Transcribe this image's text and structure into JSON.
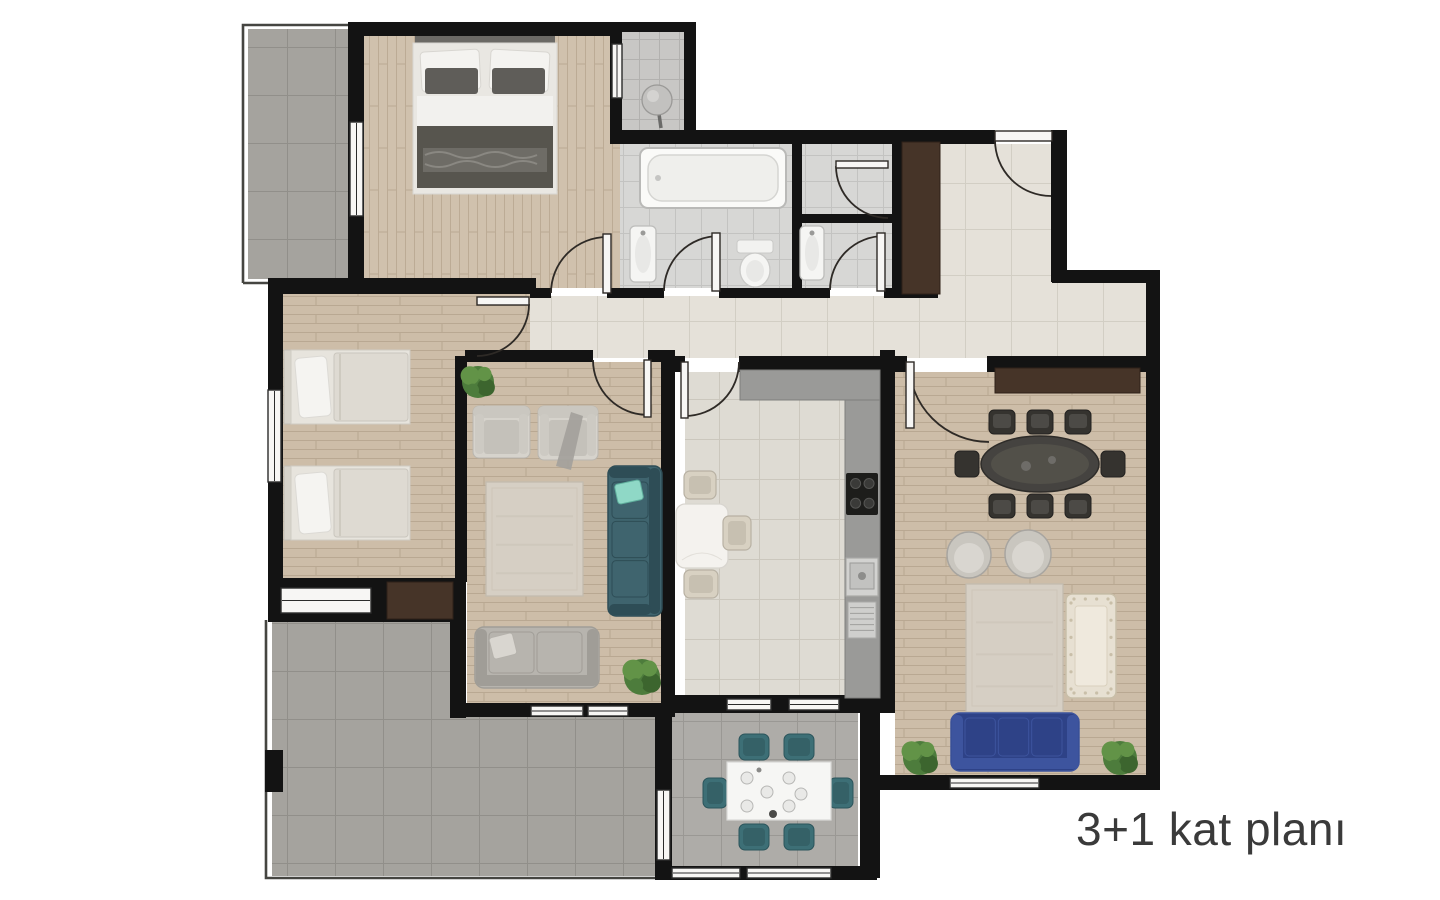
{
  "caption": {
    "text": "3+1 kat planı",
    "color": "#3a3a3a"
  },
  "palette": {
    "wall": "#131313",
    "door_line": "#2e2a26",
    "window_frame": "#2b2b2b",
    "railing": "#454541",
    "white": "#f7f6f4",
    "brown": "#463428",
    "counter": "#9a9a98",
    "counter_dark": "#7f7f7d",
    "sofa_navy": "#2e4287",
    "sofa_navy_cushion": "#3d549e",
    "teal": "#3f646e",
    "teal_dark": "#2e4d56",
    "mint": "#8fd8c6",
    "gray_sofa": "#b7b4ae",
    "gray_sofa_dark": "#a09d97",
    "cream": "#e7e0d2",
    "cream_dark": "#c9bfa9",
    "chair_dark": "#35332f",
    "chair_dark_seat": "#4c4a46",
    "table_dark": "#454340",
    "table_dark_hi": "#525049",
    "beige_chair": "#d8d1c2",
    "beige_chair_seat": "#c7c0b1",
    "balcony_chair": "#3d6f76",
    "balcony_chair_dark": "#2b545b",
    "rug": "#d6cfc4",
    "rug_line": "#c2bbae",
    "plant": "#4d7c3c",
    "plant2": "#629347",
    "plant3": "#3c652e",
    "linen": "#e9e7e2",
    "linen_dark": "#d8d6d1",
    "duvet_dark": "#57554e",
    "pillow_dark": "#5f5d59",
    "fixture": "#f5f5f3",
    "fixture_line": "#bdbdbb",
    "steel": "#c6c6c4"
  },
  "floor_patterns": {
    "wood_h": {
      "kind": "wood",
      "base": "#cdbda8",
      "line": "#b9a892",
      "vertical": false
    },
    "wood_v": {
      "kind": "wood",
      "base": "#d0c1ad",
      "line": "#bcab95",
      "vertical": true
    },
    "tile_hall": {
      "kind": "tile",
      "base": "#e5e1d9",
      "line": "#d2cec4",
      "size": 46
    },
    "tile_kitchen": {
      "kind": "tile",
      "base": "#dedbd3",
      "line": "#cbc7bd",
      "size": 40
    },
    "tile_bath": {
      "kind": "tile",
      "base": "#d7d7d5",
      "line": "#c3c3c1",
      "size": 26
    },
    "tile_niche": {
      "kind": "tile",
      "base": "#c8c7c5",
      "line": "#b2b1af",
      "size": 20
    },
    "tile_gray": {
      "kind": "tile",
      "base": "#a5a39e",
      "line": "#918f8a",
      "size": 48
    },
    "tile_balcony": {
      "kind": "tile",
      "base": "#aeaca8",
      "line": "#9a9894",
      "size": 38
    }
  },
  "floorplan": {
    "floors": [
      {
        "name": "room-balcony-top-left",
        "rect": [
          248,
          29,
          100,
          250
        ],
        "pattern": "tile_gray"
      },
      {
        "name": "room-master-bedroom",
        "rect": [
          364,
          36,
          258,
          252
        ],
        "pattern": "wood_v"
      },
      {
        "name": "room-niche",
        "rect": [
          622,
          30,
          64,
          104
        ],
        "pattern": "tile_niche"
      },
      {
        "name": "room-bathroom",
        "rect": [
          620,
          144,
          172,
          144
        ],
        "pattern": "tile_bath"
      },
      {
        "name": "room-shower",
        "rect": [
          802,
          144,
          90,
          72
        ],
        "pattern": "tile_bath"
      },
      {
        "name": "room-wc",
        "rect": [
          802,
          223,
          90,
          65
        ],
        "pattern": "tile_bath"
      },
      {
        "name": "room-entry-hall",
        "rect": [
          938,
          144,
          114,
          138
        ],
        "pattern": "tile_hall"
      },
      {
        "name": "room-hall-lower",
        "rect": [
          938,
          282,
          208,
          76
        ],
        "pattern": "tile_hall"
      },
      {
        "name": "room-corridor",
        "rect": [
          530,
          296,
          416,
          62
        ],
        "pattern": "tile_hall"
      },
      {
        "name": "room-vestibule",
        "rect": [
          283,
          294,
          247,
          62
        ],
        "pattern": "wood_h"
      },
      {
        "name": "room-kids-bedroom",
        "rect": [
          283,
          294,
          172,
          288
        ],
        "pattern": "wood_h"
      },
      {
        "name": "room-sitting-room",
        "rect": [
          467,
          362,
          194,
          343
        ],
        "pattern": "wood_h"
      },
      {
        "name": "room-kitchen",
        "rect": [
          685,
          372,
          195,
          325
        ],
        "pattern": "tile_kitchen"
      },
      {
        "name": "room-living-room",
        "rect": [
          895,
          372,
          251,
          403
        ],
        "pattern": "wood_h"
      },
      {
        "name": "room-terrace-upper",
        "rect": [
          272,
          622,
          178,
          254
        ],
        "pattern": "tile_gray"
      },
      {
        "name": "room-terrace-lower",
        "rect": [
          450,
          717,
          205,
          159
        ],
        "pattern": "tile_gray"
      },
      {
        "name": "room-balcony-bottom",
        "rect": [
          672,
          712,
          186,
          154
        ],
        "pattern": "tile_balcony"
      }
    ],
    "walls": [
      [
        348,
        22,
        274,
        14
      ],
      [
        348,
        22,
        16,
        268
      ],
      [
        610,
        22,
        84,
        10
      ],
      [
        684,
        22,
        12,
        116
      ],
      [
        610,
        22,
        12,
        118
      ],
      [
        610,
        130,
        385,
        14
      ],
      [
        1051,
        130,
        16,
        152
      ],
      [
        1052,
        270,
        108,
        13
      ],
      [
        1146,
        283,
        14,
        507
      ],
      [
        268,
        278,
        268,
        16
      ],
      [
        530,
        288,
        21,
        10
      ],
      [
        607,
        288,
        57,
        10
      ],
      [
        719,
        288,
        111,
        10
      ],
      [
        884,
        288,
        54,
        10
      ],
      [
        792,
        140,
        10,
        150
      ],
      [
        798,
        214,
        96,
        9
      ],
      [
        892,
        140,
        10,
        152
      ],
      [
        268,
        292,
        15,
        290
      ],
      [
        268,
        578,
        190,
        44
      ],
      [
        455,
        356,
        12,
        226
      ],
      [
        450,
        578,
        16,
        140
      ],
      [
        450,
        703,
        225,
        14
      ],
      [
        465,
        350,
        128,
        12
      ],
      [
        648,
        350,
        27,
        12
      ],
      [
        661,
        350,
        14,
        367
      ],
      [
        739,
        356,
        156,
        16
      ],
      [
        675,
        356,
        10,
        16
      ],
      [
        661,
        695,
        234,
        18
      ],
      [
        880,
        350,
        15,
        362
      ],
      [
        895,
        356,
        12,
        16
      ],
      [
        987,
        356,
        159,
        16
      ],
      [
        875,
        775,
        285,
        15
      ],
      [
        860,
        708,
        20,
        170
      ],
      [
        655,
        708,
        17,
        160
      ],
      [
        655,
        866,
        222,
        14
      ],
      [
        265,
        750,
        18,
        42
      ]
    ],
    "windows": [
      [
        350,
        122,
        13,
        94,
        "v"
      ],
      [
        268,
        390,
        13,
        92,
        "v"
      ],
      [
        612,
        44,
        10,
        54,
        "v"
      ],
      [
        281,
        588,
        90,
        25,
        "h"
      ],
      [
        531,
        706,
        52,
        10,
        "h"
      ],
      [
        588,
        706,
        40,
        10,
        "h"
      ],
      [
        727,
        699,
        44,
        11,
        "h"
      ],
      [
        789,
        699,
        50,
        11,
        "h"
      ],
      [
        950,
        778,
        89,
        10,
        "h"
      ],
      [
        672,
        868,
        68,
        10,
        "h"
      ],
      [
        747,
        868,
        84,
        10,
        "h"
      ],
      [
        657,
        790,
        13,
        70,
        "v"
      ]
    ],
    "railings": [
      "M243,283 L243,25 L351,25",
      "M243,283 L351,283",
      "M266,620 L266,878 L658,878"
    ],
    "doors": [
      {
        "name": "door-master-bedroom",
        "arc": "M551,293 A56,56 0 0 1 607,237",
        "leaf": [
          603,
          234,
          8,
          59
        ]
      },
      {
        "name": "door-bathroom",
        "arc": "M719,236 A55,55 0 0 0 664,291",
        "leaf": [
          712,
          233,
          8,
          58
        ]
      },
      {
        "name": "door-wc",
        "arc": "M884,236 A54,54 0 0 0 830,290",
        "leaf": [
          877,
          233,
          8,
          58
        ]
      },
      {
        "name": "door-shower",
        "arc": "M888,218 A52,52 0 0 1 836,166",
        "leaf": [
          836,
          161,
          52,
          7
        ]
      },
      {
        "name": "door-entry",
        "arc": "M995,140 A56,56 0 0 0 1051,196",
        "leaf": [
          995,
          131,
          57,
          10
        ]
      },
      {
        "name": "door-vestibule",
        "arc": "M529,304 A52,52 0 0 1 477,356",
        "leaf": [
          477,
          297,
          52,
          8
        ]
      },
      {
        "name": "door-sitting-room",
        "arc": "M593,360 A55,55 0 0 0 648,415",
        "leaf": [
          644,
          360,
          7,
          57
        ]
      },
      {
        "name": "door-kitchen",
        "arc": "M739,362 A54,54 0 0 1 685,416",
        "leaf": [
          681,
          362,
          7,
          56
        ]
      },
      {
        "name": "door-living-room",
        "arc": "M909,362 A80,80 0 0 0 989,442",
        "leaf": [
          906,
          362,
          8,
          66
        ]
      }
    ],
    "furniture": [
      {
        "type": "bed_double",
        "name": "double-bed",
        "rect": [
          413,
          36,
          144,
          158
        ]
      },
      {
        "type": "ball",
        "name": "pedestal-object",
        "rect": [
          642,
          85,
          30,
          30
        ]
      },
      {
        "type": "tub",
        "name": "bathtub",
        "rect": [
          640,
          148,
          146,
          60
        ]
      },
      {
        "type": "basin",
        "name": "washbasin",
        "rect": [
          630,
          226,
          26,
          56
        ]
      },
      {
        "type": "toilet",
        "name": "toilet",
        "rect": [
          737,
          240,
          36,
          48
        ]
      },
      {
        "type": "basin",
        "name": "washbasin",
        "rect": [
          800,
          226,
          24,
          54
        ]
      },
      {
        "type": "wardrobe",
        "name": "hall-closet",
        "rect": [
          902,
          142,
          38,
          152
        ]
      },
      {
        "type": "bed_single",
        "name": "single-bed",
        "rect": [
          284,
          350,
          126,
          74
        ]
      },
      {
        "type": "bed_single",
        "name": "single-bed",
        "rect": [
          284,
          466,
          126,
          74
        ]
      },
      {
        "type": "wardrobe",
        "name": "bedroom-closet",
        "rect": [
          387,
          582,
          66,
          37
        ]
      },
      {
        "type": "plant",
        "name": "plant",
        "rect": [
          462,
          366,
          32,
          32
        ]
      },
      {
        "type": "armchair",
        "name": "armchair",
        "rect": [
          473,
          406,
          57,
          52
        ]
      },
      {
        "type": "armchair",
        "name": "armchair",
        "rect": [
          538,
          406,
          60,
          54
        ],
        "throw": true
      },
      {
        "type": "rug",
        "name": "rug",
        "rect": [
          486,
          482,
          97,
          114
        ]
      },
      {
        "type": "sofa_v",
        "name": "teal-sofa",
        "rect": [
          608,
          466,
          54,
          150
        ],
        "color": "teal",
        "dark": "teal_dark",
        "pillow": true
      },
      {
        "type": "sofa_h",
        "name": "gray-sofa",
        "rect": [
          475,
          627,
          124,
          61
        ],
        "color": "gray_sofa",
        "dark": "gray_sofa_dark",
        "cushions": 2,
        "pillow": true
      },
      {
        "type": "plant",
        "name": "plant",
        "rect": [
          624,
          660,
          36,
          34
        ]
      },
      {
        "type": "counter",
        "name": "kitchen-counter",
        "rect": [
          740,
          370,
          140,
          30
        ]
      },
      {
        "type": "counter",
        "name": "kitchen-counter",
        "rect": [
          845,
          400,
          35,
          298
        ]
      },
      {
        "type": "cooktop",
        "name": "cooktop",
        "rect": [
          846,
          473,
          32,
          42
        ]
      },
      {
        "type": "ksink",
        "name": "kitchen-sink",
        "rect": [
          846,
          558,
          32,
          82
        ]
      },
      {
        "type": "table_sm",
        "name": "kitchen-table",
        "rect": [
          676,
          504,
          52,
          64
        ]
      },
      {
        "type": "chair_sm",
        "name": "kitchen-chair",
        "rect": [
          684,
          471,
          32,
          28
        ]
      },
      {
        "type": "chair_sm",
        "name": "kitchen-chair",
        "rect": [
          723,
          516,
          28,
          34
        ]
      },
      {
        "type": "chair_sm",
        "name": "kitchen-chair",
        "rect": [
          684,
          570,
          34,
          28
        ]
      },
      {
        "type": "sideboard",
        "name": "sideboard",
        "rect": [
          995,
          368,
          145,
          25
        ]
      },
      {
        "type": "dining_set",
        "name": "dining-table",
        "rect": [
          962,
          408,
          156,
          112
        ]
      },
      {
        "type": "round_chair",
        "name": "round-armchair",
        "rect": [
          947,
          532,
          44,
          46
        ]
      },
      {
        "type": "round_chair",
        "name": "round-armchair",
        "rect": [
          1005,
          530,
          46,
          48
        ]
      },
      {
        "type": "rug",
        "name": "rug",
        "rect": [
          966,
          584,
          97,
          128
        ]
      },
      {
        "type": "sofa_tufted",
        "name": "cream-loveseat",
        "rect": [
          1066,
          594,
          50,
          104
        ]
      },
      {
        "type": "sofa_h",
        "name": "navy-sofa",
        "rect": [
          951,
          713,
          128,
          58
        ],
        "color": "sofa_navy",
        "dark": "sofa_navy_cushion",
        "cushions": 3
      },
      {
        "type": "plant",
        "name": "plant",
        "rect": [
          903,
          741,
          34,
          34
        ]
      },
      {
        "type": "plant",
        "name": "plant",
        "rect": [
          1103,
          741,
          34,
          34
        ]
      },
      {
        "type": "balcony_set",
        "name": "balcony-dining-set",
        "rect": [
          703,
          734,
          150,
          116
        ]
      }
    ]
  }
}
